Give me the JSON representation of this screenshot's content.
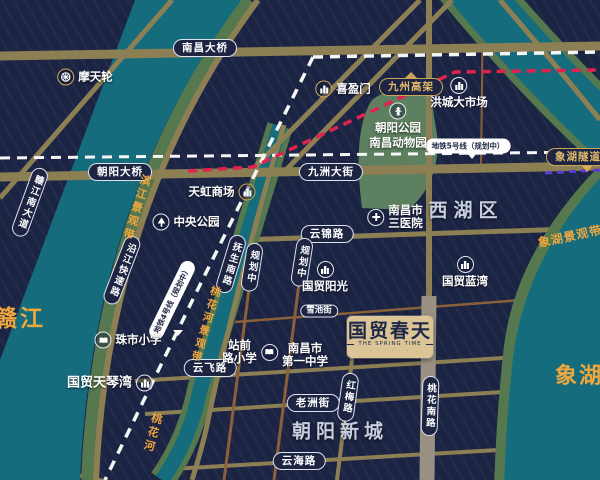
{
  "project": {
    "name": "国贸春天",
    "name_en": "THE SPRING TIME",
    "tagline": "· · · · · ·"
  },
  "areas": {
    "xihu_district": "西湖区",
    "chaoyang_newtown": "朝阳新城"
  },
  "waters": {
    "gan_river": "赣江",
    "xiang_lake": "象湖",
    "taohua_river": "桃花河"
  },
  "scenic_belts": {
    "binjiang": "滨江景观带",
    "taohua": "桃花河景观带",
    "xianghu": "象湖景观带"
  },
  "roads": {
    "nanchang_bridge": "南昌大桥",
    "chaoyang_bridge": "朝阳大桥",
    "jiuzhou_avenue": "九洲大街",
    "jiuzhou_viaduct": "九州高架",
    "yunjin_road": "云锦路",
    "xuechi_street": "雪池街",
    "yunfei_road": "云飞路",
    "laozhou_street": "老洲街",
    "yunhai_road": "云海路",
    "hongmei_road": "红梅路",
    "taohua_south_road": "桃花南路",
    "fusheng_south_road": "抚生南路",
    "planned_road_a": "规划中",
    "planned_road_b": "规划中",
    "yanjiang_expressway": "沿江快速路",
    "ganjiang_south_avenue": "赣江南大道",
    "xianghu_tunnel": "象湖隧道"
  },
  "metro": {
    "line5_label": "地铁5号线（规划中）",
    "line4_label": "地铁4号线（规划中）"
  },
  "pois": {
    "ferris_wheel": {
      "label": "摩天轮",
      "icon": "ferris-wheel"
    },
    "xiyingmen": {
      "label": "喜盈门",
      "icon": "building"
    },
    "hongcheng_market": {
      "label": "洪城大市场",
      "icon": "building"
    },
    "chaoyang_park": {
      "line1": "朝阳公园",
      "line2": "南昌动物园",
      "icon": "pagoda"
    },
    "tianhong_mall": {
      "label": "天虹商场",
      "icon": "building"
    },
    "central_park": {
      "label": "中央公园",
      "icon": "tree"
    },
    "third_hospital": {
      "line1": "南昌市",
      "line2": "三医院",
      "icon": "hospital-cross"
    },
    "guomao_sunshine": {
      "label": "国贸阳光",
      "icon": "building"
    },
    "guomao_bluebay": {
      "label": "国贸蓝湾",
      "icon": "building"
    },
    "zhushi_primary": {
      "label": "珠市小学",
      "icon": "school-book"
    },
    "guomao_tianqinwan": {
      "label": "国贸天琴湾",
      "icon": "building"
    },
    "zhanqian_primary": {
      "line1": "站前",
      "line2": "路小学",
      "icon": "school-book"
    },
    "nanchang_no1_middle": {
      "line1": "南昌市",
      "line2": "第一中学",
      "icon": "school-book"
    }
  },
  "colors": {
    "background": "#1c2444",
    "water_teal": "#156c7c",
    "bank_green": "#55784e",
    "park_green": "#5d8160",
    "road_tan": "#8d7f54",
    "road_copper": "#8a6038",
    "road_gray": "#9a9184",
    "gold_text": "#efa73e",
    "logo_gold": "#dbc495",
    "metro_red": "#e0234e",
    "metro_purple": "#5a3bd0",
    "metro_white": "#ffffff"
  }
}
